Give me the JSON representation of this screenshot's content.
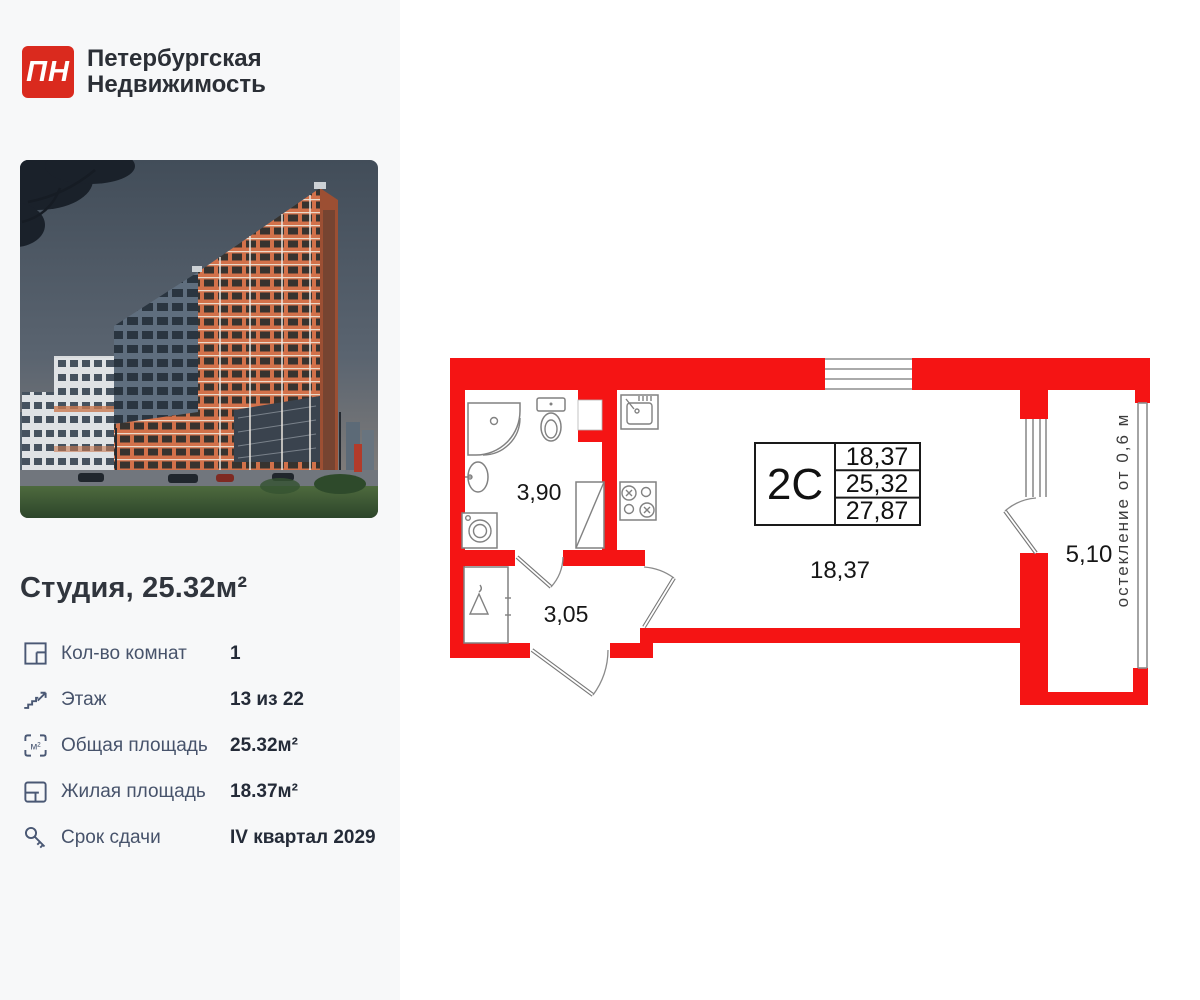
{
  "colors": {
    "brand_red": "#da2a1e",
    "plan_wall_red": "#f51414",
    "panel_bg": "#f7f8f9",
    "text_dark": "#242b38",
    "text_slate": "#47536b"
  },
  "brand": {
    "logo_monogram": "ПН",
    "name_line1": "Петербургская",
    "name_line2": "Недвижимость"
  },
  "listing": {
    "title": "Студия, 25.32м²"
  },
  "details": {
    "rooms": {
      "label": "Кол-во комнат",
      "value": "1"
    },
    "floor": {
      "label": "Этаж",
      "value": "13 из 22"
    },
    "total_area": {
      "label": "Общая площадь",
      "value": "25.32м²"
    },
    "living_area": {
      "label": "Жилая площадь",
      "value": "18.37м²"
    },
    "completion": {
      "label": "Срок сдачи",
      "value": "IV квартал 2029"
    }
  },
  "icons": {
    "area_unit": "м²"
  },
  "floor_plan": {
    "unit_label": "2С",
    "info_rows": [
      "18,37",
      "25,32",
      "27,87"
    ],
    "rooms": {
      "bathroom": "3,90",
      "hallway": "3,05",
      "living": "18,37",
      "balcony": "5,10"
    },
    "glazing_note": "остекление от 0,6 м"
  }
}
